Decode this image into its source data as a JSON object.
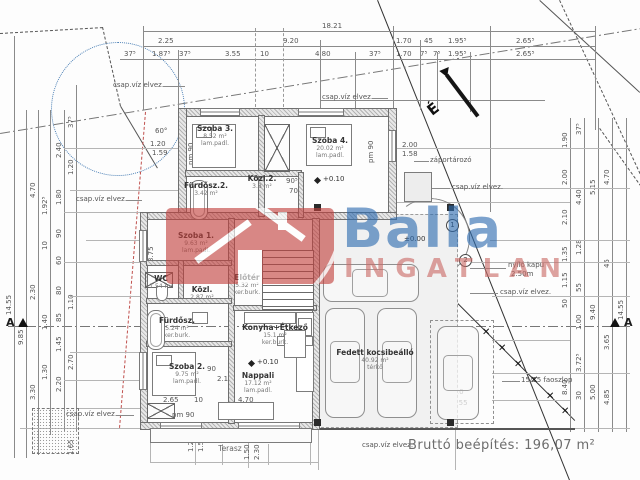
{
  "drawing": {
    "summary": "Bruttó beépítés: 196,07 m²",
    "north_label": "É",
    "section_marker": "A",
    "watermark": {
      "brand": "Balla",
      "word": "INGATLAN"
    },
    "rooms": [
      {
        "name": "Szoba 3.",
        "area": "8.52 m²",
        "floor": "lam.padl."
      },
      {
        "name": "Szoba 4.",
        "area": "20.02 m²",
        "floor": "lam.padl."
      },
      {
        "name": "Közl.2.",
        "area": "3.8 m²",
        "floor": "ker.burk."
      },
      {
        "name": "Fürdősz.2.",
        "area": "3.42 m²",
        "floor": "ker.burk."
      },
      {
        "name": "Szoba 1.",
        "area": "9.63 m²",
        "floor": "lam.padl."
      },
      {
        "name": "Előtér",
        "area": "5.32 m²",
        "floor": "ker.burk."
      },
      {
        "name": "WC",
        "area": "1.54 m²",
        "floor": "ker.burk."
      },
      {
        "name": "Közl.",
        "area": "2.87 m²",
        "floor": "ker.burk."
      },
      {
        "name": "Fürdősz.",
        "area": "5.24 m²",
        "floor": "ker.burk."
      },
      {
        "name": "Szoba 2.",
        "area": "9.75 m²",
        "floor": "lam.padl."
      },
      {
        "name": "Konyha+Étkező",
        "area": "15.1 m²",
        "floor": "ker.burk."
      },
      {
        "name": "Nappali",
        "area": "17.12 m²",
        "floor": "lam.padl."
      },
      {
        "name": "Terasz",
        "area": "",
        "floor": ""
      },
      {
        "name": "Fedett kocsibeálló",
        "area": "40.92 m²",
        "floor": "térkő"
      }
    ],
    "levels": [
      "+0.10",
      "+0.10",
      "±0.00"
    ],
    "annotations": {
      "drain": "csap.víz elvez.",
      "reservoir": "záportározó",
      "gate_l1": "nyíló kapu",
      "gate_l2": "2.50m",
      "posts": "15/15 faoszlop",
      "angle": "60°",
      "pm90": "pm 90",
      "pm180": "pm 1.80",
      "circle1": "1",
      "circle2": "2"
    },
    "dims": {
      "total": "18.21",
      "top2": [
        "2.25",
        "9.20",
        "1.70",
        "45",
        "1.95⁵",
        "2.65⁵"
      ],
      "top3": [
        "37⁵",
        "1.87⁵",
        "37⁵",
        "3.55",
        "10",
        "4.80",
        "37⁵",
        "1.70",
        "7⁵",
        "7⁵",
        "1.95⁵",
        "2.65⁵"
      ],
      "left": [
        "14.55",
        "9.85",
        "4.70",
        "2.30",
        "3.30",
        "1.92⁵",
        "10",
        "1.40",
        "1.30",
        "2.40",
        "1.80",
        "90",
        "60",
        "80",
        "85",
        "1.45",
        "2.20",
        "37⁵",
        "1.20",
        "1.10",
        "2.70",
        "1.65"
      ],
      "right": [
        "1.90",
        "2.00",
        "2.10",
        "1.35",
        "1.15",
        "50",
        "8.40",
        "37⁵",
        "4.40",
        "1.28",
        "55",
        "1.00",
        "3.72⁵",
        "30",
        "9.40",
        "5.15",
        "5.00",
        "4.70",
        "45",
        "3.65",
        "4.85",
        "14.55"
      ],
      "inner": [
        "2.65",
        "10",
        "90",
        "2.10",
        "3.75",
        "2.50",
        "2.50",
        "40",
        "2.20",
        "4.95",
        "4.55",
        "2.00",
        "1.58",
        "1.20",
        "1.60",
        "90⁵",
        "70",
        "1.20",
        "1.59",
        "4.70",
        "1.20",
        "1.50",
        "1.50",
        "2.30"
      ]
    }
  }
}
